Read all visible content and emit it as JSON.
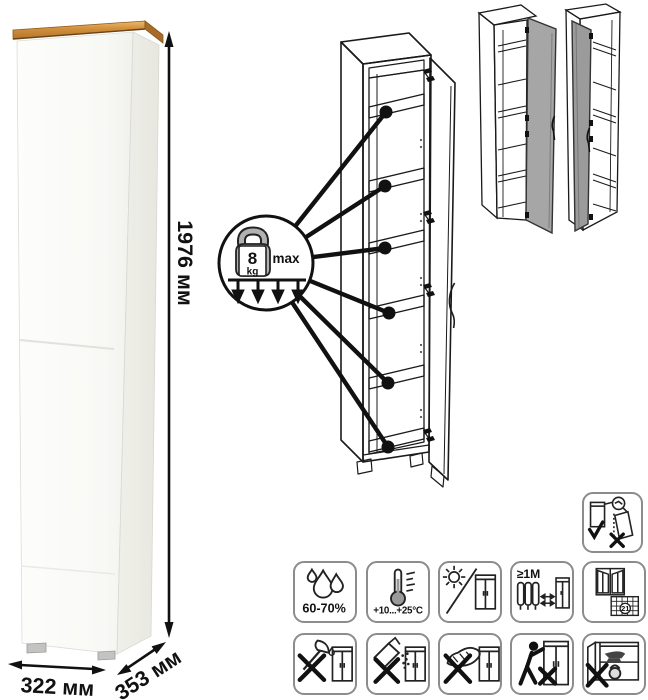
{
  "dimensions": {
    "height": "1976 мм",
    "width": "322 мм",
    "depth": "353 мм"
  },
  "load_badge": {
    "weight": "8",
    "unit": "kg",
    "max_label": "max"
  },
  "pictograms": {
    "humidity_label": "60-70%",
    "temperature_label": "+10...+25°C",
    "distance_label": "≥1М",
    "calendar_day": "21"
  },
  "pictogram_names": [
    "humidity-60-70-percent",
    "temperature-range",
    "avoid-direct-sunlight",
    "keep-1m-from-heaters",
    "ventilate-room-21-days",
    "no-sharp-tools",
    "no-abrasive-powders",
    "no-abrasive-sponges",
    "do-not-drag",
    "do-not-overload-shelves",
    "anti-tip-wall-mount"
  ],
  "colors": {
    "wood_top": "#cc8a3a",
    "line_art": "#1a1a1a",
    "door_gray": "#a6a6a6",
    "pictogram_border": "#8c8c8c"
  }
}
